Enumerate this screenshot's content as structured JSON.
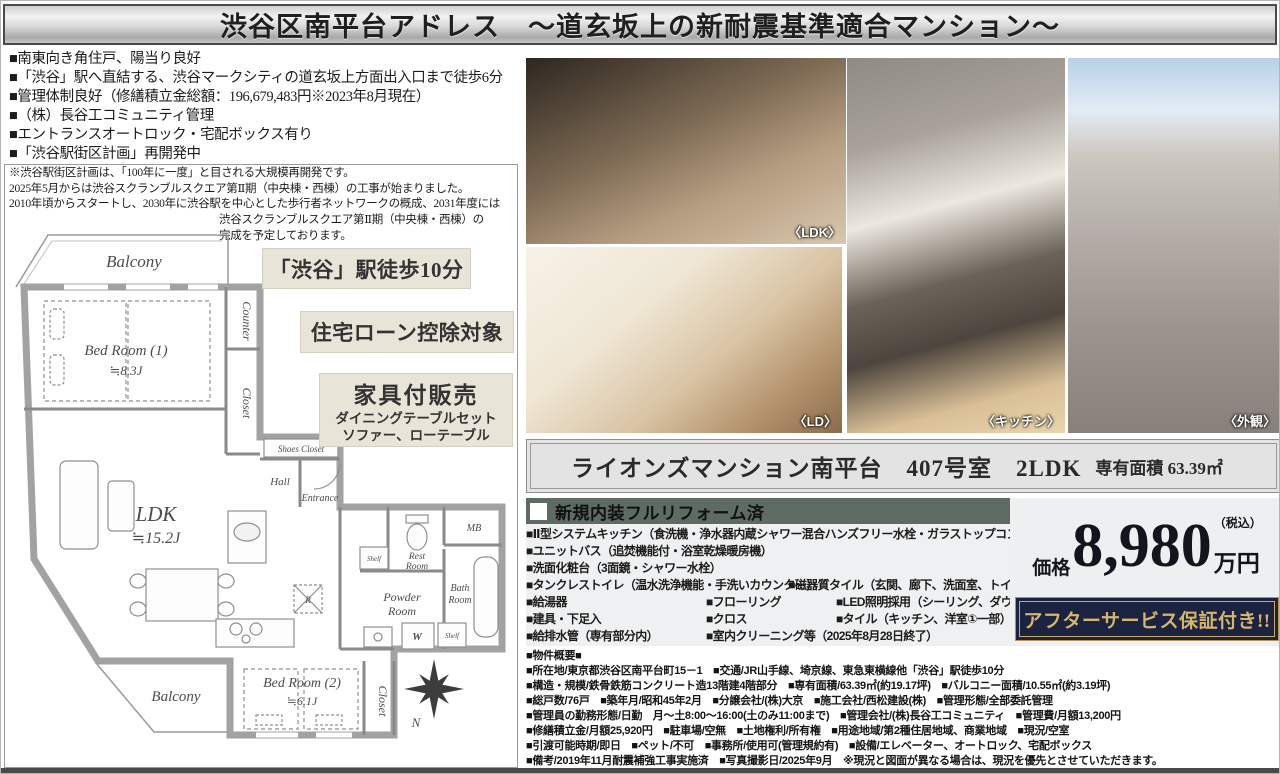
{
  "title": "渋谷区南平台アドレス　～道玄坂上の新耐震基準適合マンション～",
  "features": [
    "■南東向き角住戸、陽当り良好",
    "■「渋谷」駅へ直結する、渋谷マークシティの道玄坂上方面出入口まで徒歩6分",
    "■管理体制良好（修繕積立金総額：196,679,483円※2023年8月現在）",
    "■（株）長谷工コミュニティ管理",
    "■エントランスオートロック・宅配ボックス有り",
    "■「渋谷駅街区計画」再開発中"
  ],
  "note": {
    "main_lines": [
      "※渋谷駅街区計画は、「100年に一度」と目される大規模再開発です。",
      "2025年5月からは渋谷スクランブルスクエア第Ⅱ期（中央棟・西棟）の工事が始まりました。",
      "2010年頃からスタートし、2030年に渋谷駅を中心とした歩行者ネットワークの概成、2031年度には"
    ],
    "right_lines": [
      "渋谷スクランブルスクエア第Ⅱ期（中央棟・西棟）の",
      "完成を予定しております。"
    ]
  },
  "badges": {
    "walk": "「渋谷」駅徒歩10分",
    "loan": "住宅ローン控除対象",
    "furniture_title": "家具付販売",
    "furniture_line1": "ダイニングテーブルセット",
    "furniture_line2": "ソファー、ローテーブル"
  },
  "floorplan": {
    "balcony_top": "Balcony",
    "bedroom1_name": "Bed Room (1)",
    "bedroom1_size": "≒8.3J",
    "counter": "Counter",
    "closet_upper": "Closet",
    "shoes_closet": "Shoes Closet",
    "hall": "Hall",
    "entrance": "Entrance",
    "ldk_name": "LDK",
    "ldk_size": "≒15.2J",
    "mb": "MB",
    "rest_room_1": "Rest",
    "rest_room_2": "Room",
    "bath_room_1": "Bath",
    "bath_room_2": "Room",
    "powder_room_1": "Powder",
    "powder_room_2": "Room",
    "washer": "W",
    "shelf1": "Shelf",
    "shelf2": "Shelf",
    "fridge": "R",
    "bedroom2_name": "Bed Room (2)",
    "bedroom2_size": "≒6.1J",
    "closet_lower": "Closet",
    "balcony_bottom": "Balcony",
    "compass_n": "N"
  },
  "photos": {
    "ldk_caption": "〈LDK〉",
    "ld_caption": "〈LD〉",
    "kitchen_caption": "〈キッチン〉",
    "exterior_caption": "〈外観〉"
  },
  "name_band": {
    "main": "ライオンズマンション南平台　407号室　2LDK",
    "area": "専有面積 63.39㎡"
  },
  "reform": {
    "header": "新規内装フルリフォーム済",
    "rows": [
      [
        "■Ⅱ型システムキッチン（食洗機・浄水器内蔵シャワー混合ハンズフリー水栓・ガラストップコンロ）"
      ],
      [
        "■ユニットバス（追焚機能付・浴室乾燥暖房機）"
      ],
      [
        "■洗面化粧台（3面鏡・シャワー水栓）"
      ],
      [
        "■タンクレストイレ（温水洗浄機能・手洗いカウンター）",
        "■磁器質タイル（玄関、廊下、洗面室、トイレ）"
      ],
      [
        "■給湯器",
        "■フローリング",
        "■LED照明採用（シーリング、ダウンライト）"
      ],
      [
        "■建具・下足入",
        "■クロス",
        "■タイル（キッチン、洋室①一部）"
      ],
      [
        "■給排水管（専有部分内）",
        "■室内クリーニング等（2025年8月28日終了）"
      ]
    ]
  },
  "price": {
    "label": "価格",
    "amount": "8,980",
    "unit": "万円",
    "tax": "（税込）"
  },
  "service_badge": "アフターサービス保証付き!!",
  "overview": {
    "lines": [
      "■物件概要■",
      "■所在地/東京都渋谷区南平台町15－1　■交通/JR山手線、埼京線、東急東横線他「渋谷」駅徒歩10分",
      "■構造・規模/鉄骨鉄筋コンクリート造13階建4階部分　■専有面積/63.39㎡(約19.17坪)　■バルコニー面積/10.55㎡(約3.19坪)",
      "■総戸数/76戸　■築年月/昭和45年2月　■分譲会社/(株)大京　■施工会社/西松建設(株)　■管理形態/全部委託管理",
      "■管理員の勤務形態/日勤　月～土8:00～16:00(土のみ11:00まで)　■管理会社/(株)長谷工コミュニティ　■管理費/月額13,200円",
      "■修繕積立金/月額25,920円　■駐車場/空無　■土地権利/所有権　■用途地域/第2種住居地域、商業地域　■現況/空室",
      "■引渡可能時期/即日　■ペット/不可　■事務所/使用可(管理規約有)　■設備/エレベーター、オートロック、宅配ボックス",
      "■備考/2019年11月耐震補強工事実施済　■写真撮影日/2025年9月　※現況と図面が異なる場合は、現況を優先とさせていただきます。"
    ]
  },
  "colors": {
    "accent_navy": "#1b2340",
    "gold": "#c9a961",
    "reform_header_green": "#5e6b63",
    "badge_beige": "#e9e4d8"
  }
}
